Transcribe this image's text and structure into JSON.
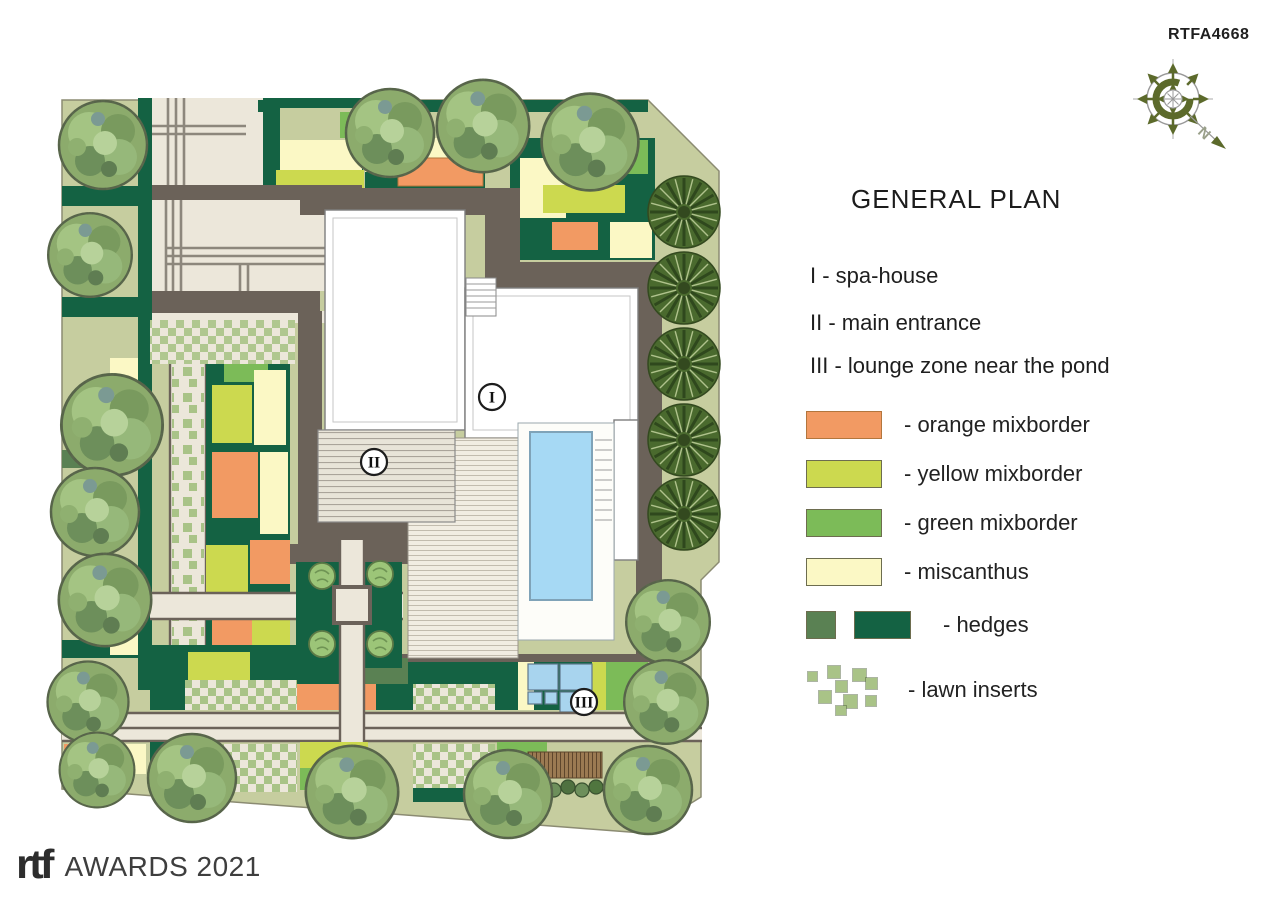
{
  "header": {
    "code": "RTFA4668"
  },
  "compass": {
    "north_label": "N"
  },
  "panel": {
    "title": "GENERAL PLAN",
    "key_items": [
      "I - spa-house",
      "II - main entrance",
      "III - lounge zone near the pond"
    ],
    "legend": [
      {
        "name": "orange-mixborder",
        "label": "- orange mixborder"
      },
      {
        "name": "yellow-mixborder",
        "label": "- yellow mixborder"
      },
      {
        "name": "green-mixborder",
        "label": "- green mixborder"
      },
      {
        "name": "miscanthus",
        "label": "- miscanthus"
      },
      {
        "name": "hedges",
        "label": "- hedges"
      },
      {
        "name": "lawn-inserts",
        "label": "- lawn inserts"
      }
    ]
  },
  "plan_markers": [
    "I",
    "II",
    "III"
  ],
  "footer": {
    "brand": "rtf",
    "text": "AWARDS 2021"
  },
  "palette": {
    "orange": "#f29a63",
    "yellow": "#ccd94f",
    "green": "#7cbb58",
    "pale-yellow": "#fbf8c5",
    "hedge-olive": "#5a8153",
    "hedge-dark": "#146243",
    "lawn-insert": "#a9c387",
    "pool-blue": "#a6d9f4",
    "water-blue": "#a8d4ee",
    "path-gray": "#6b6259",
    "paving-beige": "#ece7da",
    "site-green": "#c6cd9f"
  }
}
